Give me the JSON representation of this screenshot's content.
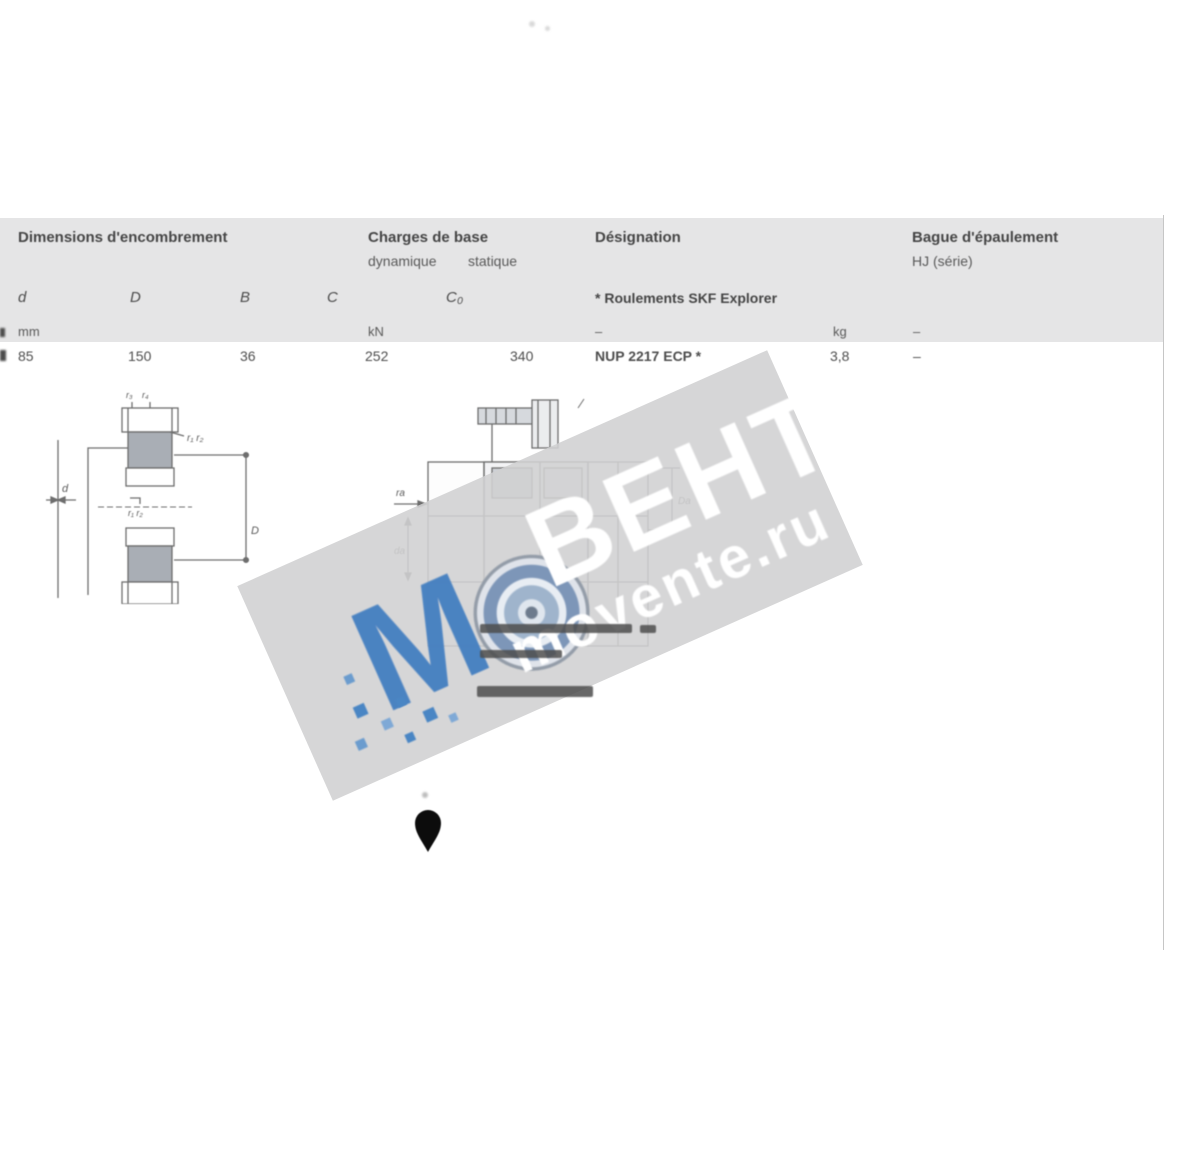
{
  "table": {
    "header": {
      "dimensions": "Dimensions d'encombrement",
      "loads": "Charges de base",
      "loads_sub_dynamic": "dynamique",
      "loads_sub_static": "statique",
      "designation": "Désignation",
      "ring": "Bague d'épaulement",
      "ring_sub": "HJ (série)",
      "explorer_note": "* Roulements SKF Explorer"
    },
    "symbols": [
      "d",
      "D",
      "B",
      "C",
      "C₀"
    ],
    "units": {
      "dimensions": "mm",
      "loads": "kN",
      "designation": "–",
      "mass": "kg",
      "ring": "–"
    },
    "row": {
      "d": "85",
      "D": "150",
      "B": "36",
      "C": "252",
      "C0": "340",
      "designation": "NUP 2217 ECP *",
      "mass": "3,8",
      "ring": "–"
    }
  },
  "drawings": {
    "left": {
      "label_bore": "d",
      "label_outer": "D",
      "label_r_top_1": "r₃",
      "label_r_top_2": "r₄",
      "label_r_side": "r₁ r₂",
      "label_r_inner": "r₁ r₂"
    },
    "center": {
      "label_ra": "ra",
      "label_da": "da",
      "label_Da": "Da"
    }
  },
  "watermark": {
    "letter_m": "М",
    "text_vent": "ВЕНТ",
    "site": "movente.ru",
    "brand_blue": "#3f7cc0",
    "band_gray": "#d2d2d2"
  }
}
